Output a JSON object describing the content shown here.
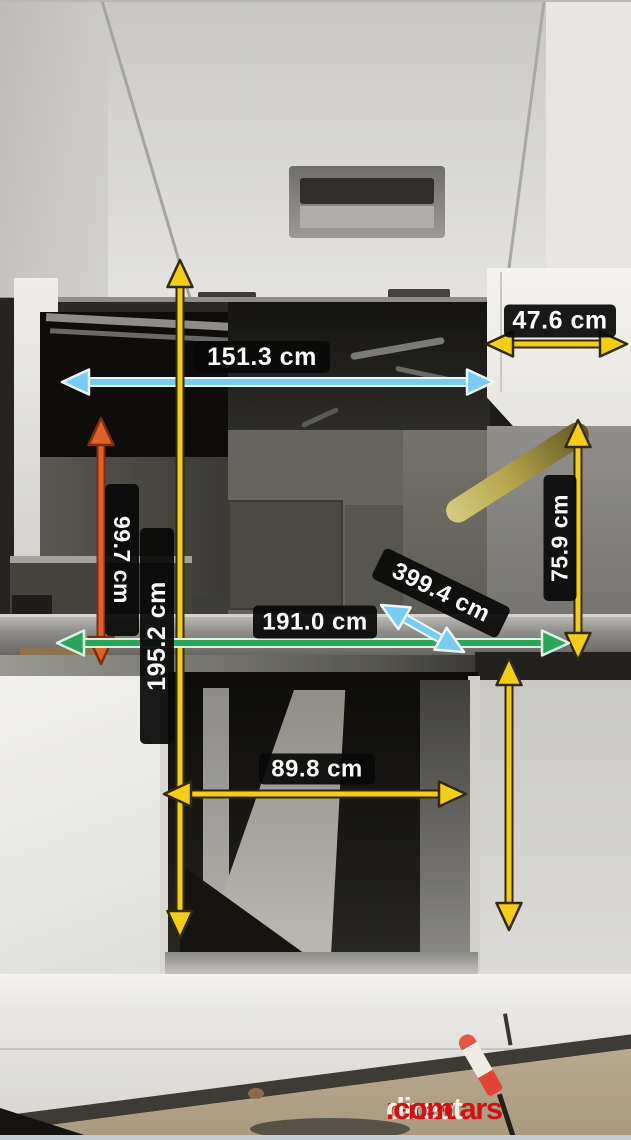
{
  "watermark": {
    "racecars": "racecars",
    "direct": "direct",
    "dotcom": ".com",
    "red": "#d21114",
    "white": "#f3f0ea"
  },
  "measurements": [
    {
      "name": "width-47-6cm",
      "value": "47.6 cm",
      "color": "#f2ce1b",
      "outline": "#33290b",
      "cw": 5,
      "ow": 9,
      "line": {
        "x1": 486,
        "y1": 344,
        "x2": 627,
        "y2": 344
      },
      "label": {
        "cx": 560,
        "cy": 321,
        "w": 112,
        "h": 33,
        "rot": 0,
        "fs": 25
      }
    },
    {
      "name": "width-151-3cm",
      "value": "151.3 cm",
      "color": "#76ccf1",
      "outline": "#eef5f8",
      "cw": 6,
      "ow": 10,
      "line": {
        "x1": 62,
        "y1": 382,
        "x2": 494,
        "y2": 382
      },
      "label": {
        "cx": 262,
        "cy": 357,
        "w": 136,
        "h": 32,
        "rot": 0,
        "fs": 25
      }
    },
    {
      "name": "height-99-7cm",
      "value": "99.7 cm",
      "color": "#e0602a",
      "outline": "#7e2d0e",
      "cw": 5,
      "ow": 9,
      "line": {
        "x1": 101,
        "y1": 418,
        "x2": 101,
        "y2": 664
      },
      "label": {
        "cx": 122,
        "cy": 560,
        "w": 152,
        "h": 34,
        "rot": 90,
        "fs": 23
      }
    },
    {
      "name": "height-195-2cm",
      "value": "195.2 cm",
      "color": "#f2ce1b",
      "outline": "#33290b",
      "cw": 5,
      "ow": 9,
      "line": {
        "x1": 180,
        "y1": 260,
        "x2": 180,
        "y2": 938
      },
      "label": {
        "cx": 157,
        "cy": 636,
        "w": 216,
        "h": 34,
        "rot": -90,
        "fs": 25
      }
    },
    {
      "name": "height-75-9cm",
      "value": "75.9 cm",
      "color": "#f2ce1b",
      "outline": "#33290b",
      "cw": 5,
      "ow": 9,
      "line": {
        "x1": 578,
        "y1": 420,
        "x2": 578,
        "y2": 660
      },
      "label": {
        "cx": 560,
        "cy": 538,
        "w": 126,
        "h": 33,
        "rot": -90,
        "fs": 23
      }
    },
    {
      "name": "width-191-0cm",
      "value": "191.0 cm",
      "color": "#2ba45c",
      "outline": "#ddf0e1",
      "cw": 6,
      "ow": 10,
      "line": {
        "x1": 57,
        "y1": 643,
        "x2": 569,
        "y2": 643
      },
      "label": {
        "cx": 315,
        "cy": 622,
        "w": 124,
        "h": 33,
        "rot": 0,
        "fs": 24
      }
    },
    {
      "name": "length-399-4cm",
      "value": "399.4 cm",
      "color": "#76ccf1",
      "outline": "#eef5f8",
      "cw": 6,
      "ow": 10,
      "line": {
        "x1": 381,
        "y1": 605,
        "x2": 464,
        "y2": 652
      },
      "label": {
        "cx": 441,
        "cy": 593,
        "w": 140,
        "h": 34,
        "rot": 26,
        "fs": 24
      }
    },
    {
      "name": "width-89-8cm",
      "value": "89.8 cm",
      "color": "#f2ce1b",
      "outline": "#33290b",
      "cw": 5,
      "ow": 9,
      "line": {
        "x1": 164,
        "y1": 794,
        "x2": 466,
        "y2": 794
      },
      "label": {
        "cx": 317,
        "cy": 769,
        "w": 116,
        "h": 31,
        "rot": 0,
        "fs": 24
      }
    },
    {
      "name": "height-right-lower",
      "value": "",
      "color": "#f2ce1b",
      "outline": "#33290b",
      "cw": 5,
      "ow": 9,
      "line": {
        "x1": 509,
        "y1": 658,
        "x2": 509,
        "y2": 930
      }
    }
  ]
}
